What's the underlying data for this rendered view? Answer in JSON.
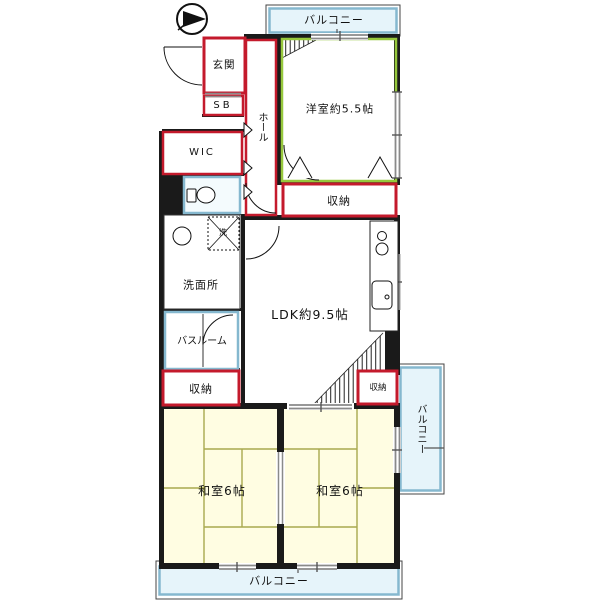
{
  "plan": {
    "balcony_top": "バルコニー",
    "balcony_right": "バルコニー",
    "balcony_bottom": "バルコニー",
    "genkan": "玄関",
    "sb": "SB",
    "hall": "ホール",
    "wic": "WIC",
    "western_room": "洋室約5.5帖",
    "storage_west": "収納",
    "storage_left": "収納",
    "storage_ldk": "収納",
    "washroom": "洗面所",
    "washer": "洗",
    "bathroom": "バスルーム",
    "ldk": "LDK約9.5帖",
    "japanese_room_left": "和室6帖",
    "japanese_room_right": "和室6帖"
  },
  "colors": {
    "wall": "#1a1a1a",
    "red_wall": "#c41a2c",
    "green_wall": "#96c83c",
    "blue_wall": "#85b8cf",
    "balcony_fill": "#e6f4fa",
    "tatami_fill": "#fffde2",
    "tatami_line": "#a9a94e",
    "window_gray": "#8a8a8a"
  }
}
